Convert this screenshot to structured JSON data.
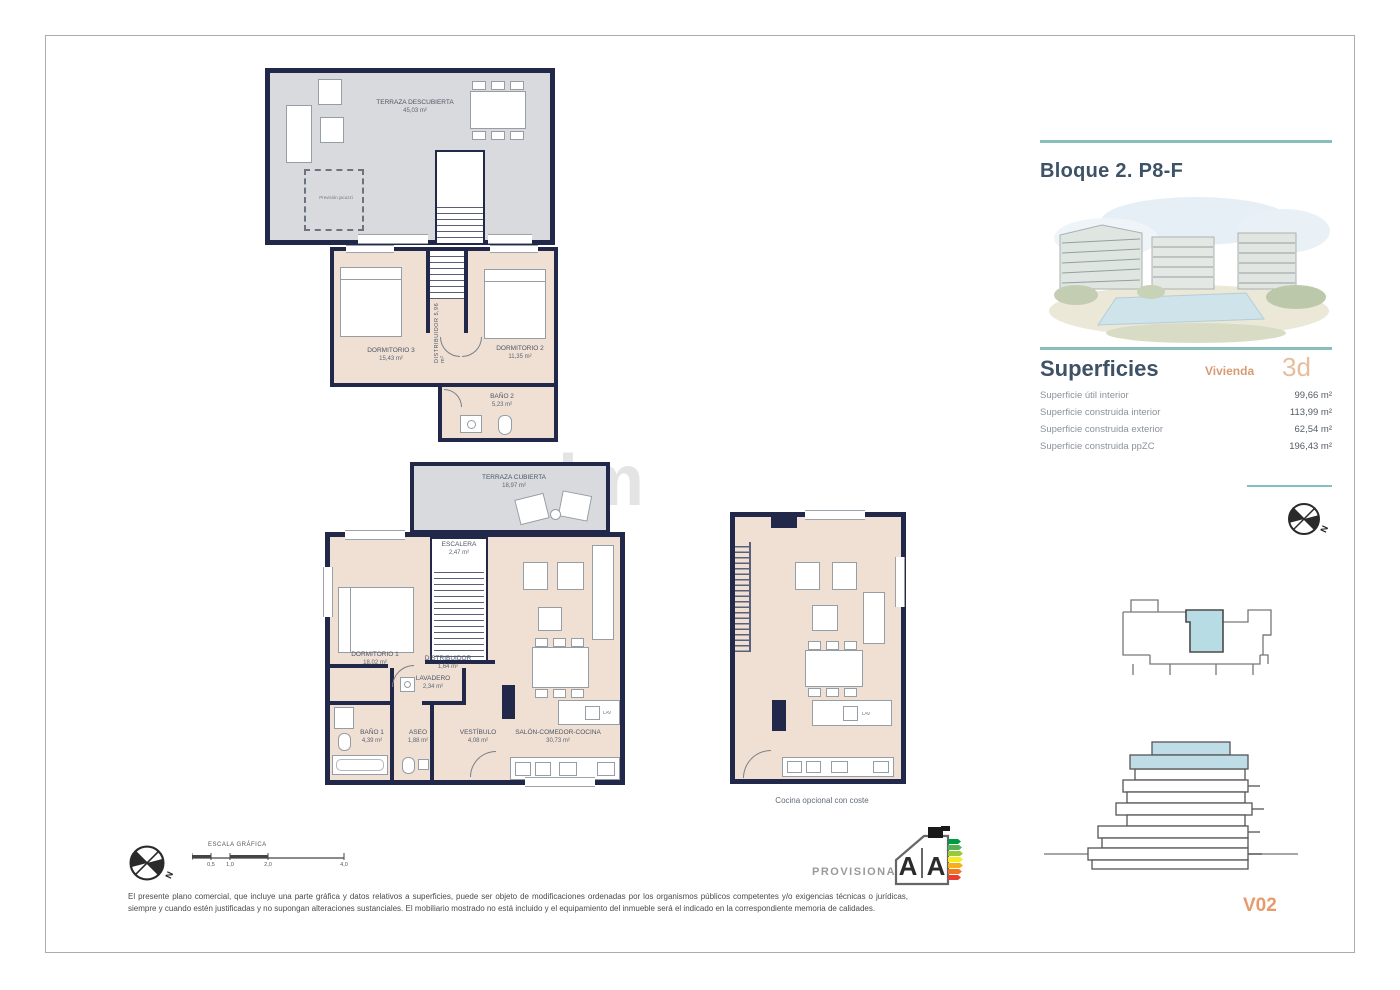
{
  "watermark": "lm",
  "compass": {
    "north": "N"
  },
  "plans": {
    "terrace_upper": {
      "label": "TERRAZA DESCUBIERTA",
      "area": "45,03 m²",
      "note": "Previsión jacuzzi"
    },
    "floor_upper": {
      "dorm3": {
        "label": "DORMITORIO 3",
        "area": "15,43 m²"
      },
      "dorm2": {
        "label": "DORMITORIO 2",
        "area": "11,35 m²"
      },
      "distribuidor": {
        "label": "DISTRIBUIDOR",
        "area": "5,96 m²"
      },
      "bano2": {
        "label": "BAÑO 2",
        "area": "5,23 m²"
      }
    },
    "floor_main": {
      "terraza_cubierta": {
        "label": "TERRAZA CUBIERTA",
        "area": "18,97 m²"
      },
      "escalera": {
        "label": "ESCALERA",
        "area": "2,47 m²"
      },
      "dorm1": {
        "label": "DORMITORIO 1",
        "area": "18,02 m²"
      },
      "distribuidor": {
        "label": "DISTRIBUIDOR",
        "area": "1,64 m²"
      },
      "lavadero": {
        "label": "LAVADERO",
        "area": "2,34 m²"
      },
      "bano1": {
        "label": "BAÑO 1",
        "area": "4,39 m²"
      },
      "aseo": {
        "label": "ASEO",
        "area": "1,88 m²"
      },
      "vestibulo": {
        "label": "VESTÍBULO",
        "area": "4,08 m²"
      },
      "salon": {
        "label": "SALÓN-COMEDOR-COCINA",
        "area": "30,73 m²"
      },
      "appliance_tag": "LAV"
    },
    "kitchen_optional": {
      "caption": "Cocina opcional con coste",
      "appliance_tag": "LAV"
    }
  },
  "panel": {
    "title": "Bloque 2. P8-F",
    "superficies": {
      "heading": "Superficies",
      "vivienda_label": "Vivienda",
      "vivienda_type": "3d",
      "rows": [
        {
          "label": "Superficie útil interior",
          "value": "99,66 m²"
        },
        {
          "label": "Superficie construida interior",
          "value": "113,99 m²"
        },
        {
          "label": "Superficie construida exterior",
          "value": "62,54 m²"
        },
        {
          "label": "Superficie construida ppZC",
          "value": "196,43 m²"
        }
      ]
    },
    "version": "V02"
  },
  "footer": {
    "scale": {
      "label": "ESCALA GRÁFICA",
      "ticks": [
        "0,5",
        "1,0",
        "2,0",
        "4,0"
      ]
    },
    "provisional": "PROVISIONAL",
    "energy": {
      "letter_left": "A",
      "letter_right": "A"
    },
    "disclaimer": "El presente plano comercial, que incluye una parte gráfica y datos relativos a superficies, puede ser objeto de modificaciones ordenadas por los organismos públicos competentes y/o exigencias técnicas o jurídicas, siempre y cuando estén justificadas y no supongan alteraciones sustanciales. El mobiliario mostrado no está incluido y el equipamiento del inmueble será el indicado en la correspondiente memoria de calidades."
  },
  "colors": {
    "accent_teal": "#88bebd",
    "wall_navy": "#212849",
    "floor_beige": "#efe0d3",
    "terrace_gray": "#d8dadd",
    "highlight_blue": "#b8dce4",
    "accent_orange": "#e89a6d"
  }
}
